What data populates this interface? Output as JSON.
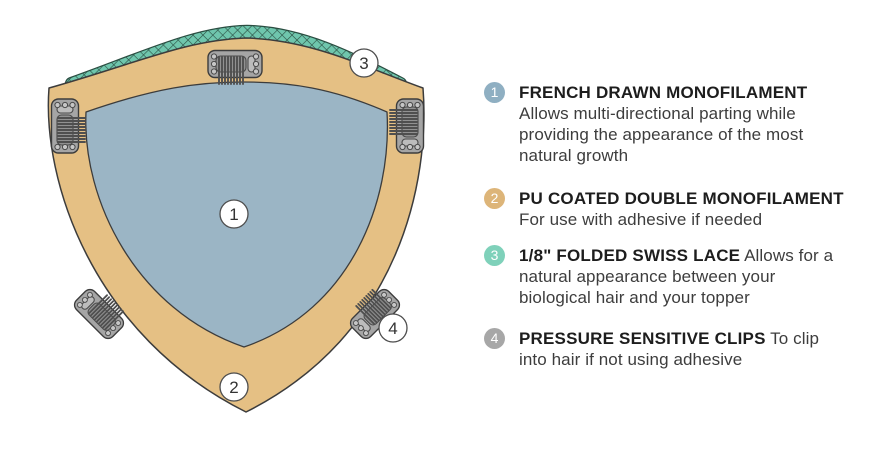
{
  "diagram": {
    "callouts": [
      {
        "number": "1",
        "target": "french-drawn-monofilament-area"
      },
      {
        "number": "2",
        "target": "pu-coated-base-area"
      },
      {
        "number": "3",
        "target": "folded-swiss-lace-edge"
      },
      {
        "number": "4",
        "target": "pressure-sensitive-clip"
      }
    ],
    "colors": {
      "pu_tan": "#e5c084",
      "monofilament_blue": "#9bb5c5",
      "lace_teal": "#6fc6ad",
      "lace_line": "#2a4d41",
      "clip_gray": "#a5a5a5",
      "clip_detail": "#919191",
      "clip_bar": "#bcbcbc",
      "rivet_fill": "#c6c6c6",
      "outline": "#3c3c3c"
    }
  },
  "legend": {
    "items": [
      {
        "number": "1",
        "badge_color": "#8fafc2",
        "title": "FRENCH DRAWN MONOFILAMENT",
        "description": "Allows multi-directional parting while providing the appearance of the most natural growth"
      },
      {
        "number": "2",
        "badge_color": "#ddb579",
        "title": "PU COATED  DOUBLE MONOFILAMENT",
        "description": "For use with adhesive if needed"
      },
      {
        "number": "3",
        "badge_color": "#7fd1ba",
        "title": "1/8\" FOLDED SWISS LACE",
        "description": "Allows for a natural appearance between your biological hair and your topper"
      },
      {
        "number": "4",
        "badge_color": "#a7a7a7",
        "title": "PRESSURE SENSITIVE CLIPS",
        "description": "To clip into hair if not using adhesive"
      }
    ]
  }
}
